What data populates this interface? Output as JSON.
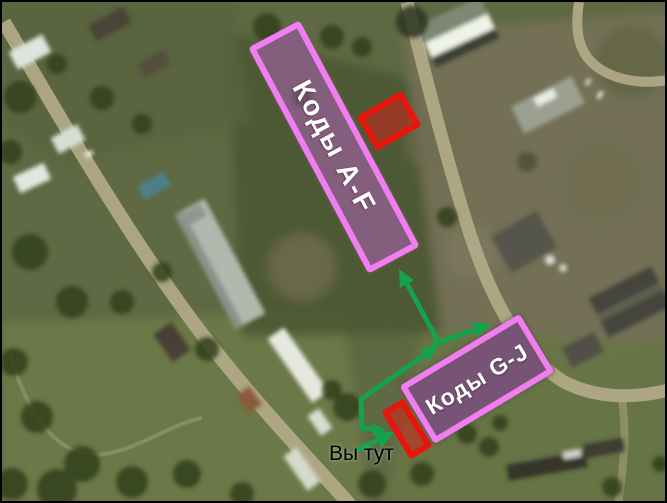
{
  "map": {
    "zones": [
      {
        "label": "Коды A-F"
      },
      {
        "label": "Коды G-J"
      }
    ],
    "you_are_here": "Вы тут"
  },
  "colors": {
    "zone_border": "#f07ef0",
    "zone_fill": "rgba(153,92,163,0.5)",
    "highlight_red": "#e9140c",
    "highlight_red_fill": "rgba(210,35,22,0.55)",
    "arrow_green": "#14a24d",
    "label_text": "#ffffff",
    "you_text": "#000000"
  }
}
